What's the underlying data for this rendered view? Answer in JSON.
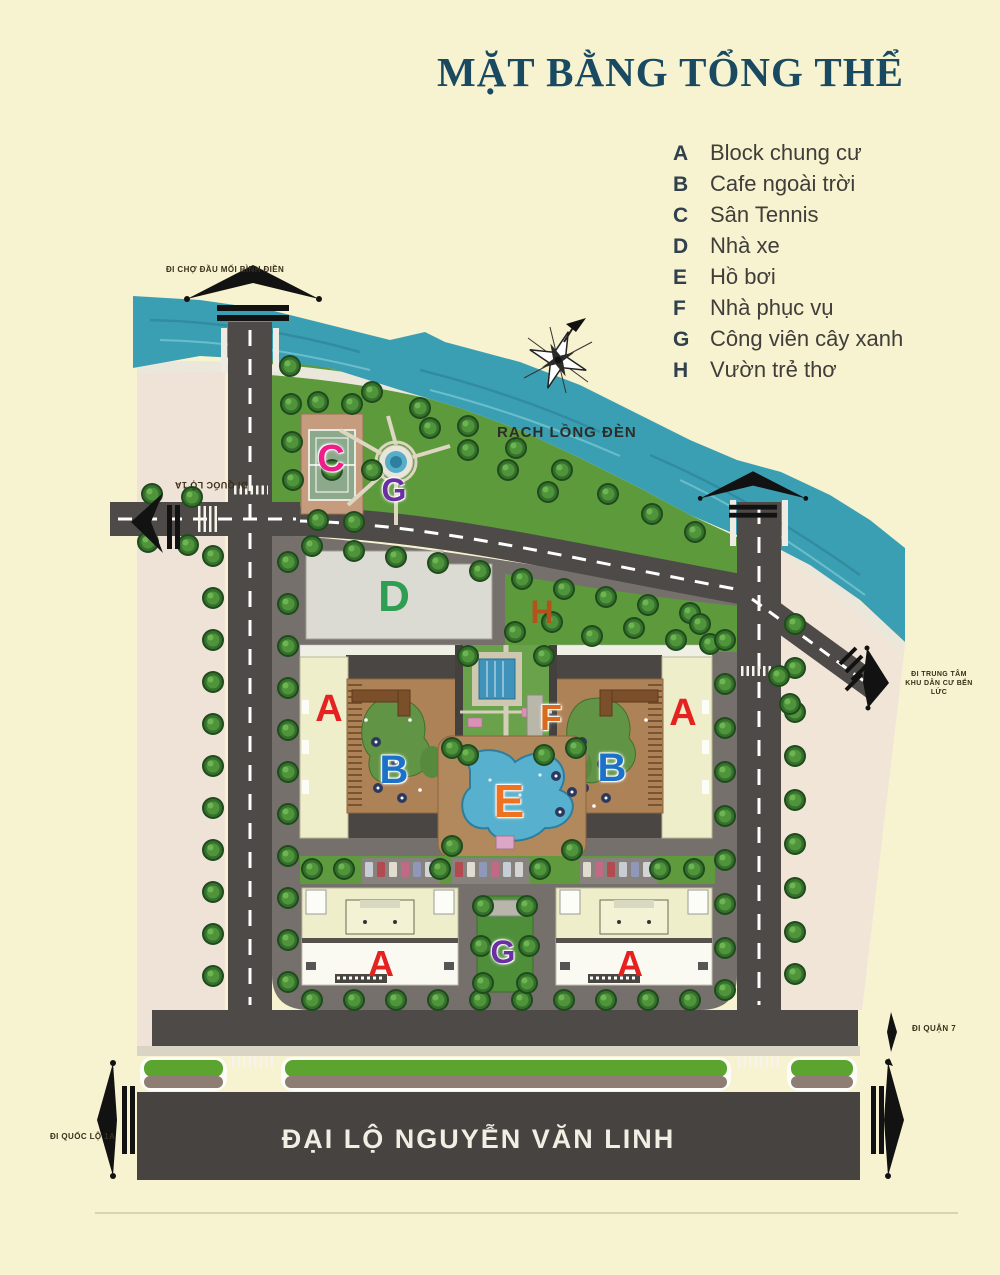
{
  "title": "MẶT BẰNG TỔNG THỂ",
  "legend": {
    "items": [
      {
        "key": "A",
        "label": "Block chung cư"
      },
      {
        "key": "B",
        "label": "Cafe ngoài trời"
      },
      {
        "key": "C",
        "label": "Sân Tennis"
      },
      {
        "key": "D",
        "label": "Nhà xe"
      },
      {
        "key": "E",
        "label": "Hồ bơi"
      },
      {
        "key": "F",
        "label": "Nhà phục vụ"
      },
      {
        "key": "G",
        "label": "Công viên cây xanh"
      },
      {
        "key": "H",
        "label": "Vườn trẻ thơ"
      }
    ]
  },
  "map": {
    "waterway_label": "RẠCH LỒNG ĐÈN",
    "boulevard_label": "ĐẠI LỘ NGUYỄN VĂN LINH",
    "directions": {
      "binh_dien_market": "ĐI CHỢ ĐẦU MỐI BÌNH ĐIỀN",
      "quoc_lo_1a_west": "ĐI QUỐC LỘ 1A",
      "ben_luc_center_line1": "ĐI TRUNG TÂM",
      "ben_luc_center_line2": "KHU DÂN CƯ BẾN LỨC",
      "district_7": "ĐI QUẬN 7",
      "quoc_lo_1a_south": "ĐI QUỐC LỘ 1A"
    },
    "markers": [
      {
        "key": "C"
      },
      {
        "key": "G"
      },
      {
        "key": "D"
      },
      {
        "key": "H"
      },
      {
        "key": "A"
      },
      {
        "key": "A"
      },
      {
        "key": "B"
      },
      {
        "key": "B"
      },
      {
        "key": "F"
      },
      {
        "key": "E"
      },
      {
        "key": "G"
      },
      {
        "key": "A"
      },
      {
        "key": "A"
      }
    ]
  },
  "colors": {
    "background": "#f7f2cf",
    "title": "#1a4a61",
    "river": "#3b9fb3",
    "road": "#4e4a47",
    "land_pink": "#efe2d7",
    "park_green": "#5c9a3c",
    "marker_a": "#e42320",
    "marker_b": "#1c72c8",
    "marker_c": "#ee1d8a",
    "marker_d": "#2e9e52",
    "marker_e": "#ef7221",
    "marker_f": "#d96b1e",
    "marker_g": "#6a2fa0",
    "marker_h": "#b5521b"
  }
}
